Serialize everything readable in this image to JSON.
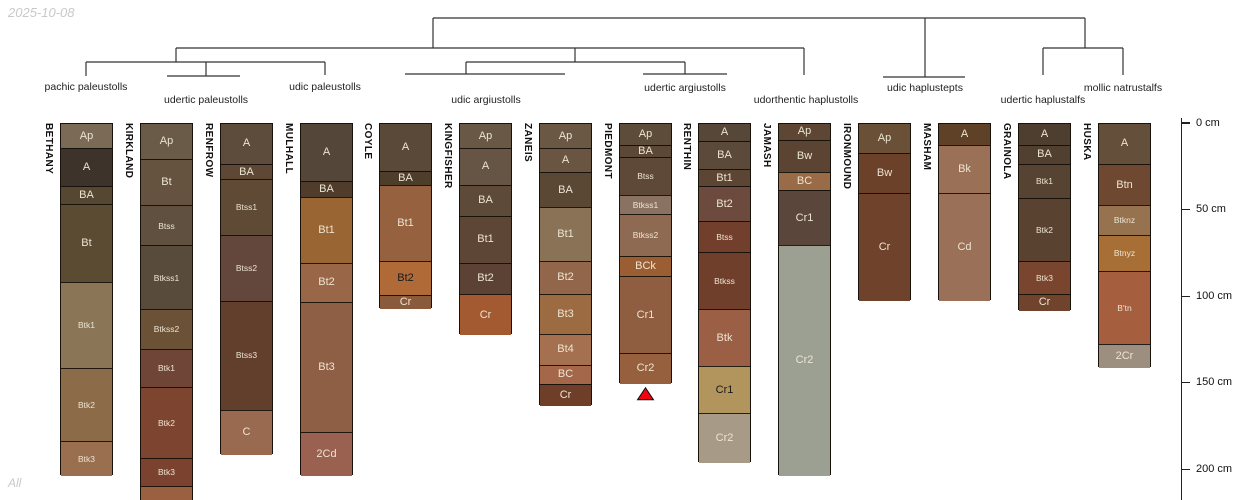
{
  "header": {
    "date": "2025-10-08"
  },
  "footer": {
    "note": "All"
  },
  "dendrogram": {
    "line_color": "#333333",
    "groups": [
      {
        "label": "pachic paleustolls",
        "x": 86,
        "y": 81
      },
      {
        "label": "udertic paleustolls",
        "x": 206,
        "y": 94
      },
      {
        "label": "udic paleustolls",
        "x": 325,
        "y": 81
      },
      {
        "label": "udic argiustolls",
        "x": 486,
        "y": 94
      },
      {
        "label": "udertic argiustolls",
        "x": 685,
        "y": 82
      },
      {
        "label": "udorthentic haplustolls",
        "x": 806,
        "y": 94
      },
      {
        "label": "udic haplustepts",
        "x": 925,
        "y": 82
      },
      {
        "label": "udertic haplustalfs",
        "x": 1043,
        "y": 94
      },
      {
        "label": "mollic natrustalfs",
        "x": 1123,
        "y": 82
      }
    ],
    "segments": [
      [
        433,
        18,
        1085,
        18
      ],
      [
        433,
        18,
        433,
        48
      ],
      [
        1085,
        18,
        1085,
        48
      ],
      [
        176,
        48,
        804,
        48
      ],
      [
        176,
        48,
        176,
        62
      ],
      [
        86,
        62,
        325,
        62
      ],
      [
        86,
        62,
        86,
        76
      ],
      [
        325,
        62,
        325,
        75
      ],
      [
        206,
        62,
        206,
        76
      ],
      [
        167,
        76,
        240,
        76
      ],
      [
        575,
        48,
        575,
        62
      ],
      [
        466,
        62,
        685,
        62
      ],
      [
        466,
        62,
        466,
        74
      ],
      [
        405,
        74,
        565,
        74
      ],
      [
        685,
        62,
        685,
        74
      ],
      [
        643,
        74,
        727,
        74
      ],
      [
        804,
        48,
        804,
        75
      ],
      [
        925,
        18,
        925,
        77
      ],
      [
        883,
        77,
        965,
        77
      ],
      [
        1043,
        48,
        1123,
        48
      ],
      [
        1043,
        48,
        1043,
        75
      ],
      [
        1123,
        48,
        1123,
        75
      ]
    ]
  },
  "axis": {
    "unit": "cm",
    "ticks": [
      {
        "cm": 0,
        "label": "0 cm"
      },
      {
        "cm": 50,
        "label": "50 cm"
      },
      {
        "cm": 100,
        "label": "100 cm"
      },
      {
        "cm": 150,
        "label": "150 cm"
      },
      {
        "cm": 200,
        "label": "200 cm"
      }
    ]
  },
  "marker_color": "#f2050f",
  "profiles": [
    {
      "name": "BETHANY",
      "x": 60,
      "horizons": [
        {
          "name": "Ap",
          "top_cm": 0,
          "bottom_cm": 14,
          "color": "#7a6a56"
        },
        {
          "name": "A",
          "top_cm": 14,
          "bottom_cm": 36,
          "color": "#3e332a"
        },
        {
          "name": "BA",
          "top_cm": 36,
          "bottom_cm": 46,
          "color": "#564732"
        },
        {
          "name": "Bt",
          "top_cm": 46,
          "bottom_cm": 91,
          "color": "#5c4b33"
        },
        {
          "name": "Btk1",
          "top_cm": 91,
          "bottom_cm": 141,
          "color": "#8b7557"
        },
        {
          "name": "Btk2",
          "top_cm": 141,
          "bottom_cm": 183,
          "color": "#8c6c48"
        },
        {
          "name": "Btk3",
          "top_cm": 183,
          "bottom_cm": 203,
          "color": "#9a6f4f"
        }
      ]
    },
    {
      "name": "KIRKLAND",
      "x": 140,
      "horizons": [
        {
          "name": "Ap",
          "top_cm": 0,
          "bottom_cm": 20,
          "color": "#6a5a48"
        },
        {
          "name": "Bt",
          "top_cm": 20,
          "bottom_cm": 47,
          "color": "#655340"
        },
        {
          "name": "Btss",
          "top_cm": 47,
          "bottom_cm": 70,
          "color": "#60503f"
        },
        {
          "name": "Btkss1",
          "top_cm": 70,
          "bottom_cm": 107,
          "color": "#594b3c"
        },
        {
          "name": "Btkss2",
          "top_cm": 107,
          "bottom_cm": 130,
          "color": "#6b5136"
        },
        {
          "name": "Btk1",
          "top_cm": 130,
          "bottom_cm": 152,
          "color": "#6f4538"
        },
        {
          "name": "Btk2",
          "top_cm": 152,
          "bottom_cm": 193,
          "color": "#7d452f"
        },
        {
          "name": "Btk3",
          "top_cm": 193,
          "bottom_cm": 209,
          "color": "#7b4230"
        },
        {
          "name": "",
          "top_cm": 209,
          "bottom_cm": 222,
          "color": "#9a6040"
        }
      ]
    },
    {
      "name": "RENFROW",
      "x": 220,
      "horizons": [
        {
          "name": "A",
          "top_cm": 0,
          "bottom_cm": 23,
          "color": "#5d4c3b"
        },
        {
          "name": "BA",
          "top_cm": 23,
          "bottom_cm": 32,
          "color": "#5e4734"
        },
        {
          "name": "Btss1",
          "top_cm": 32,
          "bottom_cm": 64,
          "color": "#5f4a36"
        },
        {
          "name": "Btss2",
          "top_cm": 64,
          "bottom_cm": 102,
          "color": "#64473c"
        },
        {
          "name": "Btss3",
          "top_cm": 102,
          "bottom_cm": 165,
          "color": "#623f2d"
        },
        {
          "name": "C",
          "top_cm": 165,
          "bottom_cm": 191,
          "color": "#9a6a50"
        }
      ]
    },
    {
      "name": "MULHALL",
      "x": 300,
      "horizons": [
        {
          "name": "A",
          "top_cm": 0,
          "bottom_cm": 33,
          "color": "#55463a"
        },
        {
          "name": "BA",
          "top_cm": 33,
          "bottom_cm": 42,
          "color": "#4f3c2b"
        },
        {
          "name": "Bt1",
          "top_cm": 42,
          "bottom_cm": 80,
          "color": "#996633"
        },
        {
          "name": "Bt2",
          "top_cm": 80,
          "bottom_cm": 103,
          "color": "#9a6648"
        },
        {
          "name": "Bt3",
          "top_cm": 103,
          "bottom_cm": 178,
          "color": "#8f5f45"
        },
        {
          "name": "2Cd",
          "top_cm": 178,
          "bottom_cm": 203,
          "color": "#9a6050"
        }
      ]
    },
    {
      "name": "COYLE",
      "x": 379,
      "horizons": [
        {
          "name": "A",
          "top_cm": 0,
          "bottom_cm": 27,
          "color": "#5a4938"
        },
        {
          "name": "BA",
          "top_cm": 27,
          "bottom_cm": 35,
          "color": "#4f3d2c"
        },
        {
          "name": "Bt1",
          "top_cm": 35,
          "bottom_cm": 79,
          "color": "#95613f"
        },
        {
          "name": "Bt2",
          "top_cm": 79,
          "bottom_cm": 99,
          "color": "#b06a38",
          "dark_label": true
        },
        {
          "name": "Cr",
          "top_cm": 99,
          "bottom_cm": 107,
          "color": "#8a5a3c"
        }
      ]
    },
    {
      "name": "KINGFISHER",
      "x": 459,
      "horizons": [
        {
          "name": "Ap",
          "top_cm": 0,
          "bottom_cm": 14,
          "color": "#6a5847"
        },
        {
          "name": "A",
          "top_cm": 14,
          "bottom_cm": 35,
          "color": "#665445"
        },
        {
          "name": "BA",
          "top_cm": 35,
          "bottom_cm": 53,
          "color": "#5e4a38"
        },
        {
          "name": "Bt1",
          "top_cm": 53,
          "bottom_cm": 80,
          "color": "#5d4635"
        },
        {
          "name": "Bt2",
          "top_cm": 80,
          "bottom_cm": 98,
          "color": "#5c4234"
        },
        {
          "name": "Cr",
          "top_cm": 98,
          "bottom_cm": 122,
          "color": "#a35a31"
        }
      ]
    },
    {
      "name": "ZANEIS",
      "x": 539,
      "horizons": [
        {
          "name": "Ap",
          "top_cm": 0,
          "bottom_cm": 14,
          "color": "#6b5844"
        },
        {
          "name": "A",
          "top_cm": 14,
          "bottom_cm": 28,
          "color": "#695542"
        },
        {
          "name": "BA",
          "top_cm": 28,
          "bottom_cm": 48,
          "color": "#5a4835"
        },
        {
          "name": "Bt1",
          "top_cm": 48,
          "bottom_cm": 79,
          "color": "#8a7257"
        },
        {
          "name": "Bt2",
          "top_cm": 79,
          "bottom_cm": 98,
          "color": "#91664a"
        },
        {
          "name": "Bt3",
          "top_cm": 98,
          "bottom_cm": 121,
          "color": "#9c6b41"
        },
        {
          "name": "Bt4",
          "top_cm": 121,
          "bottom_cm": 139,
          "color": "#a4704f"
        },
        {
          "name": "BC",
          "top_cm": 139,
          "bottom_cm": 150,
          "color": "#a5674a"
        },
        {
          "name": "Cr",
          "top_cm": 150,
          "bottom_cm": 163,
          "color": "#6f3e28"
        }
      ]
    },
    {
      "name": "PIEDMONT",
      "x": 619,
      "marker": true,
      "horizons": [
        {
          "name": "Ap",
          "top_cm": 0,
          "bottom_cm": 12,
          "color": "#5e4c3a"
        },
        {
          "name": "BA",
          "top_cm": 12,
          "bottom_cm": 19,
          "color": "#5c4836"
        },
        {
          "name": "Btss",
          "top_cm": 19,
          "bottom_cm": 41,
          "color": "#5e4938"
        },
        {
          "name": "Btkss1",
          "top_cm": 41,
          "bottom_cm": 52,
          "color": "#8a7262"
        },
        {
          "name": "Btkss2",
          "top_cm": 52,
          "bottom_cm": 76,
          "color": "#8f6a52"
        },
        {
          "name": "BCk",
          "top_cm": 76,
          "bottom_cm": 88,
          "color": "#9b5e33"
        },
        {
          "name": "Cr1",
          "top_cm": 88,
          "bottom_cm": 132,
          "color": "#8f5d3f"
        },
        {
          "name": "Cr2",
          "top_cm": 132,
          "bottom_cm": 150,
          "color": "#96603f"
        }
      ]
    },
    {
      "name": "RENTHIN",
      "x": 698,
      "horizons": [
        {
          "name": "A",
          "top_cm": 0,
          "bottom_cm": 10,
          "color": "#564739"
        },
        {
          "name": "BA",
          "top_cm": 10,
          "bottom_cm": 26,
          "color": "#5b4a3a"
        },
        {
          "name": "Bt1",
          "top_cm": 26,
          "bottom_cm": 36,
          "color": "#5c4533"
        },
        {
          "name": "Bt2",
          "top_cm": 36,
          "bottom_cm": 56,
          "color": "#6c4a3e"
        },
        {
          "name": "Btss",
          "top_cm": 56,
          "bottom_cm": 74,
          "color": "#713f2b"
        },
        {
          "name": "Btkss",
          "top_cm": 74,
          "bottom_cm": 107,
          "color": "#6f3f2b"
        },
        {
          "name": "Btk",
          "top_cm": 107,
          "bottom_cm": 140,
          "color": "#9a5f44"
        },
        {
          "name": "Cr1",
          "top_cm": 140,
          "bottom_cm": 167,
          "color": "#b2955c",
          "dark_label": true
        },
        {
          "name": "Cr2",
          "top_cm": 167,
          "bottom_cm": 196,
          "color": "#a79a87"
        }
      ]
    },
    {
      "name": "JAMASH",
      "x": 778,
      "horizons": [
        {
          "name": "Ap",
          "top_cm": 0,
          "bottom_cm": 9,
          "color": "#5d4633"
        },
        {
          "name": "Bw",
          "top_cm": 9,
          "bottom_cm": 28,
          "color": "#5c4433"
        },
        {
          "name": "BC",
          "top_cm": 28,
          "bottom_cm": 38,
          "color": "#9a6b47"
        },
        {
          "name": "Cr1",
          "top_cm": 38,
          "bottom_cm": 70,
          "color": "#5b463b"
        },
        {
          "name": "Cr2",
          "top_cm": 70,
          "bottom_cm": 203,
          "color": "#9ba093"
        }
      ]
    },
    {
      "name": "IRONMOUND",
      "x": 858,
      "horizons": [
        {
          "name": "Ap",
          "top_cm": 0,
          "bottom_cm": 17,
          "color": "#6b5038"
        },
        {
          "name": "Bw",
          "top_cm": 17,
          "bottom_cm": 40,
          "color": "#6b4129"
        },
        {
          "name": "Cr",
          "top_cm": 40,
          "bottom_cm": 102,
          "color": "#6f432b"
        }
      ]
    },
    {
      "name": "MASHAM",
      "x": 938,
      "horizons": [
        {
          "name": "A",
          "top_cm": 0,
          "bottom_cm": 12,
          "color": "#5f4127"
        },
        {
          "name": "Bk",
          "top_cm": 12,
          "bottom_cm": 40,
          "color": "#9a7057"
        },
        {
          "name": "Cd",
          "top_cm": 40,
          "bottom_cm": 102,
          "color": "#9b7058"
        }
      ]
    },
    {
      "name": "GRAINOLA",
      "x": 1018,
      "horizons": [
        {
          "name": "A",
          "top_cm": 0,
          "bottom_cm": 12,
          "color": "#4e3e2f"
        },
        {
          "name": "BA",
          "top_cm": 12,
          "bottom_cm": 23,
          "color": "#51402f"
        },
        {
          "name": "Btk1",
          "top_cm": 23,
          "bottom_cm": 43,
          "color": "#564331"
        },
        {
          "name": "Btk2",
          "top_cm": 43,
          "bottom_cm": 79,
          "color": "#594330"
        },
        {
          "name": "Btk3",
          "top_cm": 79,
          "bottom_cm": 98,
          "color": "#7a452e"
        },
        {
          "name": "Cr",
          "top_cm": 98,
          "bottom_cm": 108,
          "color": "#70432d"
        }
      ]
    },
    {
      "name": "HUSKA",
      "x": 1098,
      "horizons": [
        {
          "name": "A",
          "top_cm": 0,
          "bottom_cm": 23,
          "color": "#64503a"
        },
        {
          "name": "Btn",
          "top_cm": 23,
          "bottom_cm": 47,
          "color": "#6f4831"
        },
        {
          "name": "Btknz",
          "top_cm": 47,
          "bottom_cm": 64,
          "color": "#97724f"
        },
        {
          "name": "Btnyz",
          "top_cm": 64,
          "bottom_cm": 85,
          "color": "#a76f35"
        },
        {
          "name": "B'tn",
          "top_cm": 85,
          "bottom_cm": 127,
          "color": "#a55e3e"
        },
        {
          "name": "2Cr",
          "top_cm": 127,
          "bottom_cm": 141,
          "color": "#9d8f80"
        }
      ]
    }
  ]
}
